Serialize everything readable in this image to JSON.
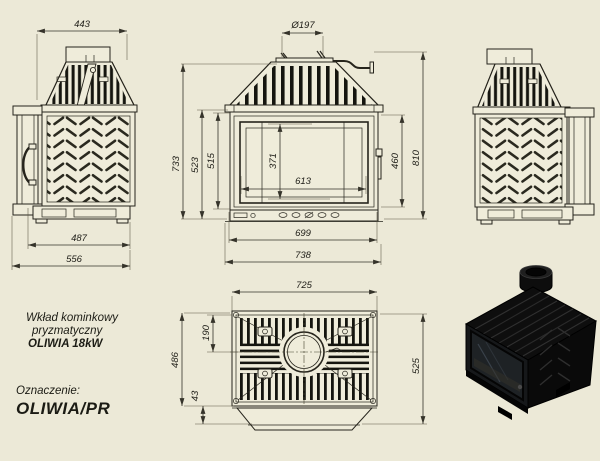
{
  "page": {
    "background": "#ece9d7",
    "ink": "#26241c",
    "dim_ink": "#35332a"
  },
  "product": {
    "line1": "Wkład kominkowy",
    "line2": "pryzmatyczny",
    "line3": "OLIWIA 18kW",
    "designation_label": "Oznaczenie:",
    "designation_value": "OLIWIA/PR"
  },
  "dims": {
    "side_left": {
      "top_width": "443",
      "base_width": "487",
      "total_depth": "556"
    },
    "front": {
      "flue": "Ø197",
      "h733": "733",
      "h523": "523",
      "h515": "515",
      "glass_h": "371",
      "glass_w": "613",
      "door_h": "460",
      "h810": "810",
      "w_inner": "699",
      "w_overall": "738"
    },
    "top": {
      "width": "725",
      "flue_center": "190",
      "depth_body": "486",
      "front_lip": "43",
      "depth_overall": "525"
    }
  }
}
